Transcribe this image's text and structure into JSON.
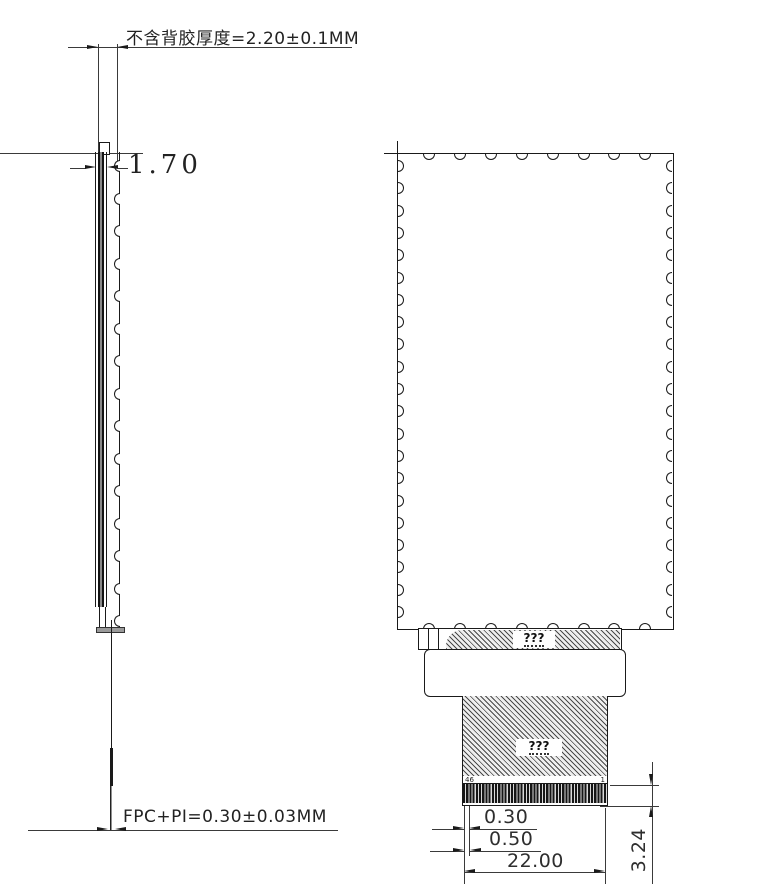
{
  "annotations": {
    "top_thickness": "不含背胶厚度=2.20±0.1MM",
    "panel_thickness": "1.70",
    "fpc_thickness": "FPC+PI=0.30±0.03MM"
  },
  "dimensions": {
    "finger_offset": "0.30",
    "finger_pitch": "0.50",
    "fpc_width": "22.00",
    "finger_length": "3.24"
  },
  "fpc": {
    "band_label": "???",
    "tail_label": "???",
    "pin_first": "46",
    "pin_last": "1"
  },
  "drawing": {
    "line_color": "#1a1a1a",
    "background": "#ffffff"
  }
}
